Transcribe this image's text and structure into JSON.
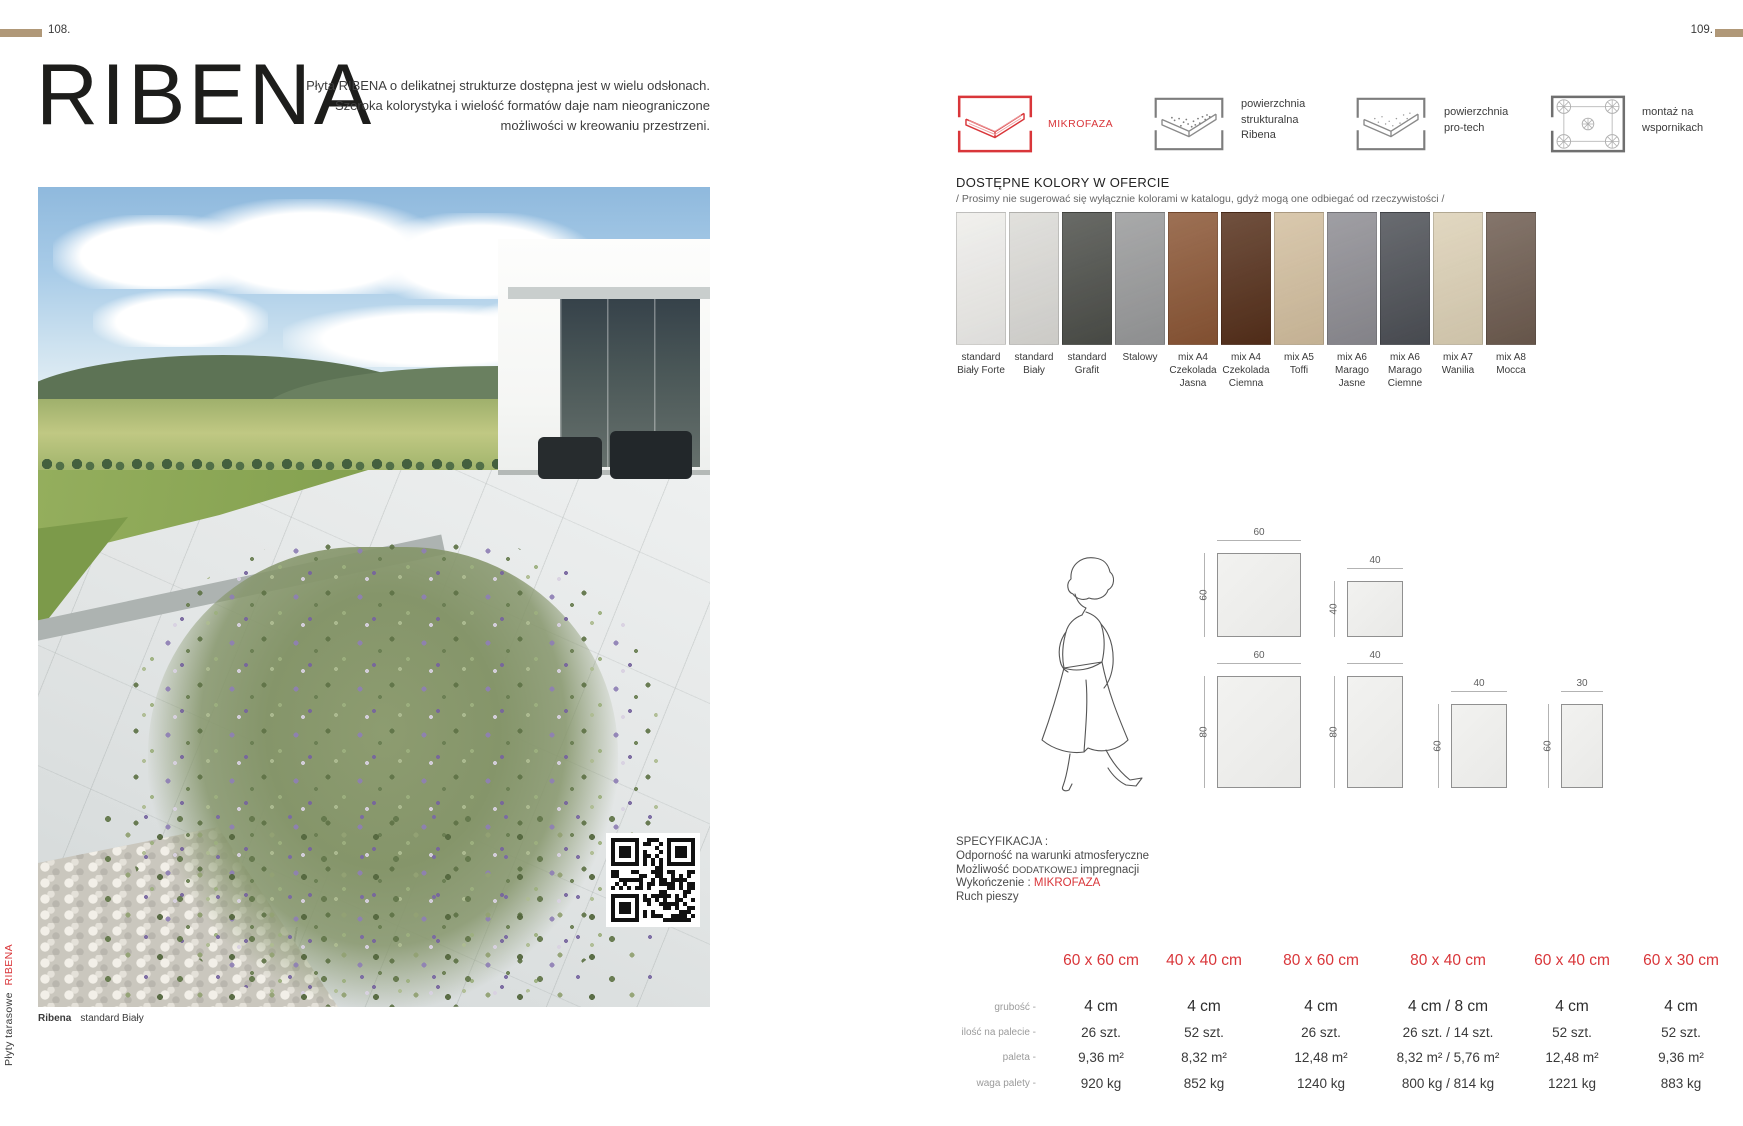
{
  "page": {
    "left_number": "108.",
    "right_number": "109."
  },
  "accent_color": "#d9363a",
  "marker_color": "#b09878",
  "left_page": {
    "title": "RIBENA",
    "intro_lines": [
      "Płyta RIBENA o delikatnej strukturze dostępna jest w wielu odsłonach.",
      "Szeroka kolorystyka i wielość formatów daje nam nieograniczone",
      "możliwości w kreowaniu przestrzeni."
    ],
    "photo_caption": {
      "product": "Ribena",
      "variant": "standard Biały"
    },
    "side_label": {
      "category": "Płyty tarasowe",
      "product": "RIBENA"
    }
  },
  "features": [
    {
      "icon": "mikrofaza-icon",
      "accent": true,
      "label_lines": [
        "MIKROFAZA"
      ]
    },
    {
      "icon": "structural-surface-icon",
      "label_lines": [
        "powierzchnia",
        "strukturalna",
        "Ribena"
      ]
    },
    {
      "icon": "pro-tech-surface-icon",
      "label_lines": [
        "powierzchnia",
        "pro-tech"
      ]
    },
    {
      "icon": "pedestal-mount-icon",
      "label_lines": [
        "montaż na",
        "wspornikach"
      ]
    }
  ],
  "colors_section": {
    "heading": "DOSTĘPNE KOLORY W OFERCIE",
    "note": "/ Prosimy nie sugerować się wyłącznie kolorami w katalogu, gdyż mogą one odbiegać od rzeczywistości /",
    "swatches": [
      {
        "label_lines": [
          "standard",
          "Biały Forte"
        ],
        "color": "#eeedea"
      },
      {
        "label_lines": [
          "standard",
          "Biały"
        ],
        "color": "#dbdad6"
      },
      {
        "label_lines": [
          "standard",
          "Grafit"
        ],
        "color": "#4c4e49"
      },
      {
        "label_lines": [
          "Stalowy"
        ],
        "color": "#98999a"
      },
      {
        "label_lines": [
          "mix A4",
          "Czekolada",
          "Jasna"
        ],
        "color": "#8a5534"
      },
      {
        "label_lines": [
          "mix A4",
          "Czekolada",
          "Ciemna"
        ],
        "color": "#552f1a"
      },
      {
        "label_lines": [
          "mix A5",
          "Toffi"
        ],
        "color": "#d2be9e"
      },
      {
        "label_lines": [
          "mix A6",
          "Marago",
          "Jasne"
        ],
        "color": "#8d8c92"
      },
      {
        "label_lines": [
          "mix A6",
          "Marago",
          "Ciemne"
        ],
        "color": "#4c4f55"
      },
      {
        "label_lines": [
          "mix A7",
          "Wanilia"
        ],
        "color": "#dcd0b5"
      },
      {
        "label_lines": [
          "mix A8",
          "Mocca"
        ],
        "color": "#6d5b4f"
      }
    ]
  },
  "sizes_diagram": {
    "rects": [
      {
        "top_label": "60",
        "side_label": "60"
      },
      {
        "top_label": "40",
        "side_label": "40"
      },
      {
        "top_label": "60",
        "side_label": "80"
      },
      {
        "top_label": "40",
        "side_label": "80"
      },
      {
        "top_label": "40",
        "side_label": "60"
      },
      {
        "top_label": "30",
        "side_label": "60"
      }
    ]
  },
  "specs": {
    "heading": "SPECYFIKACJA :",
    "line1": "Odporność na warunki atmosferyczne",
    "line2": {
      "pre": "Możliwość ",
      "caps": "DODATKOWEJ",
      "post": " impregnacji"
    },
    "line3": {
      "pre": "Wykończenie : ",
      "accent": "MIKROFAZA"
    },
    "line4": "Ruch pieszy"
  },
  "table": {
    "row_labels": [
      "grubość -",
      "ilość na palecie -",
      "paleta -",
      "waga palety -"
    ],
    "columns": [
      {
        "header": "60 x 60 cm",
        "values": [
          "4 cm",
          "26 szt.",
          "9,36 m²",
          "920 kg"
        ]
      },
      {
        "header": "40 x 40 cm",
        "values": [
          "4 cm",
          "52 szt.",
          "8,32 m²",
          "852 kg"
        ]
      },
      {
        "header": "80 x 60 cm",
        "values": [
          "4 cm",
          "26 szt.",
          "12,48 m²",
          "1240 kg"
        ]
      },
      {
        "header": "80 x 40 cm",
        "values": [
          "4 cm / 8 cm",
          "26 szt. / 14 szt.",
          "8,32 m² / 5,76 m²",
          "800 kg / 814 kg"
        ]
      },
      {
        "header": "60 x 40 cm",
        "values": [
          "4 cm",
          "52 szt.",
          "12,48 m²",
          "1221 kg"
        ]
      },
      {
        "header": "60 x 30 cm",
        "values": [
          "4 cm",
          "52 szt.",
          "9,36 m²",
          "883 kg"
        ]
      }
    ]
  }
}
